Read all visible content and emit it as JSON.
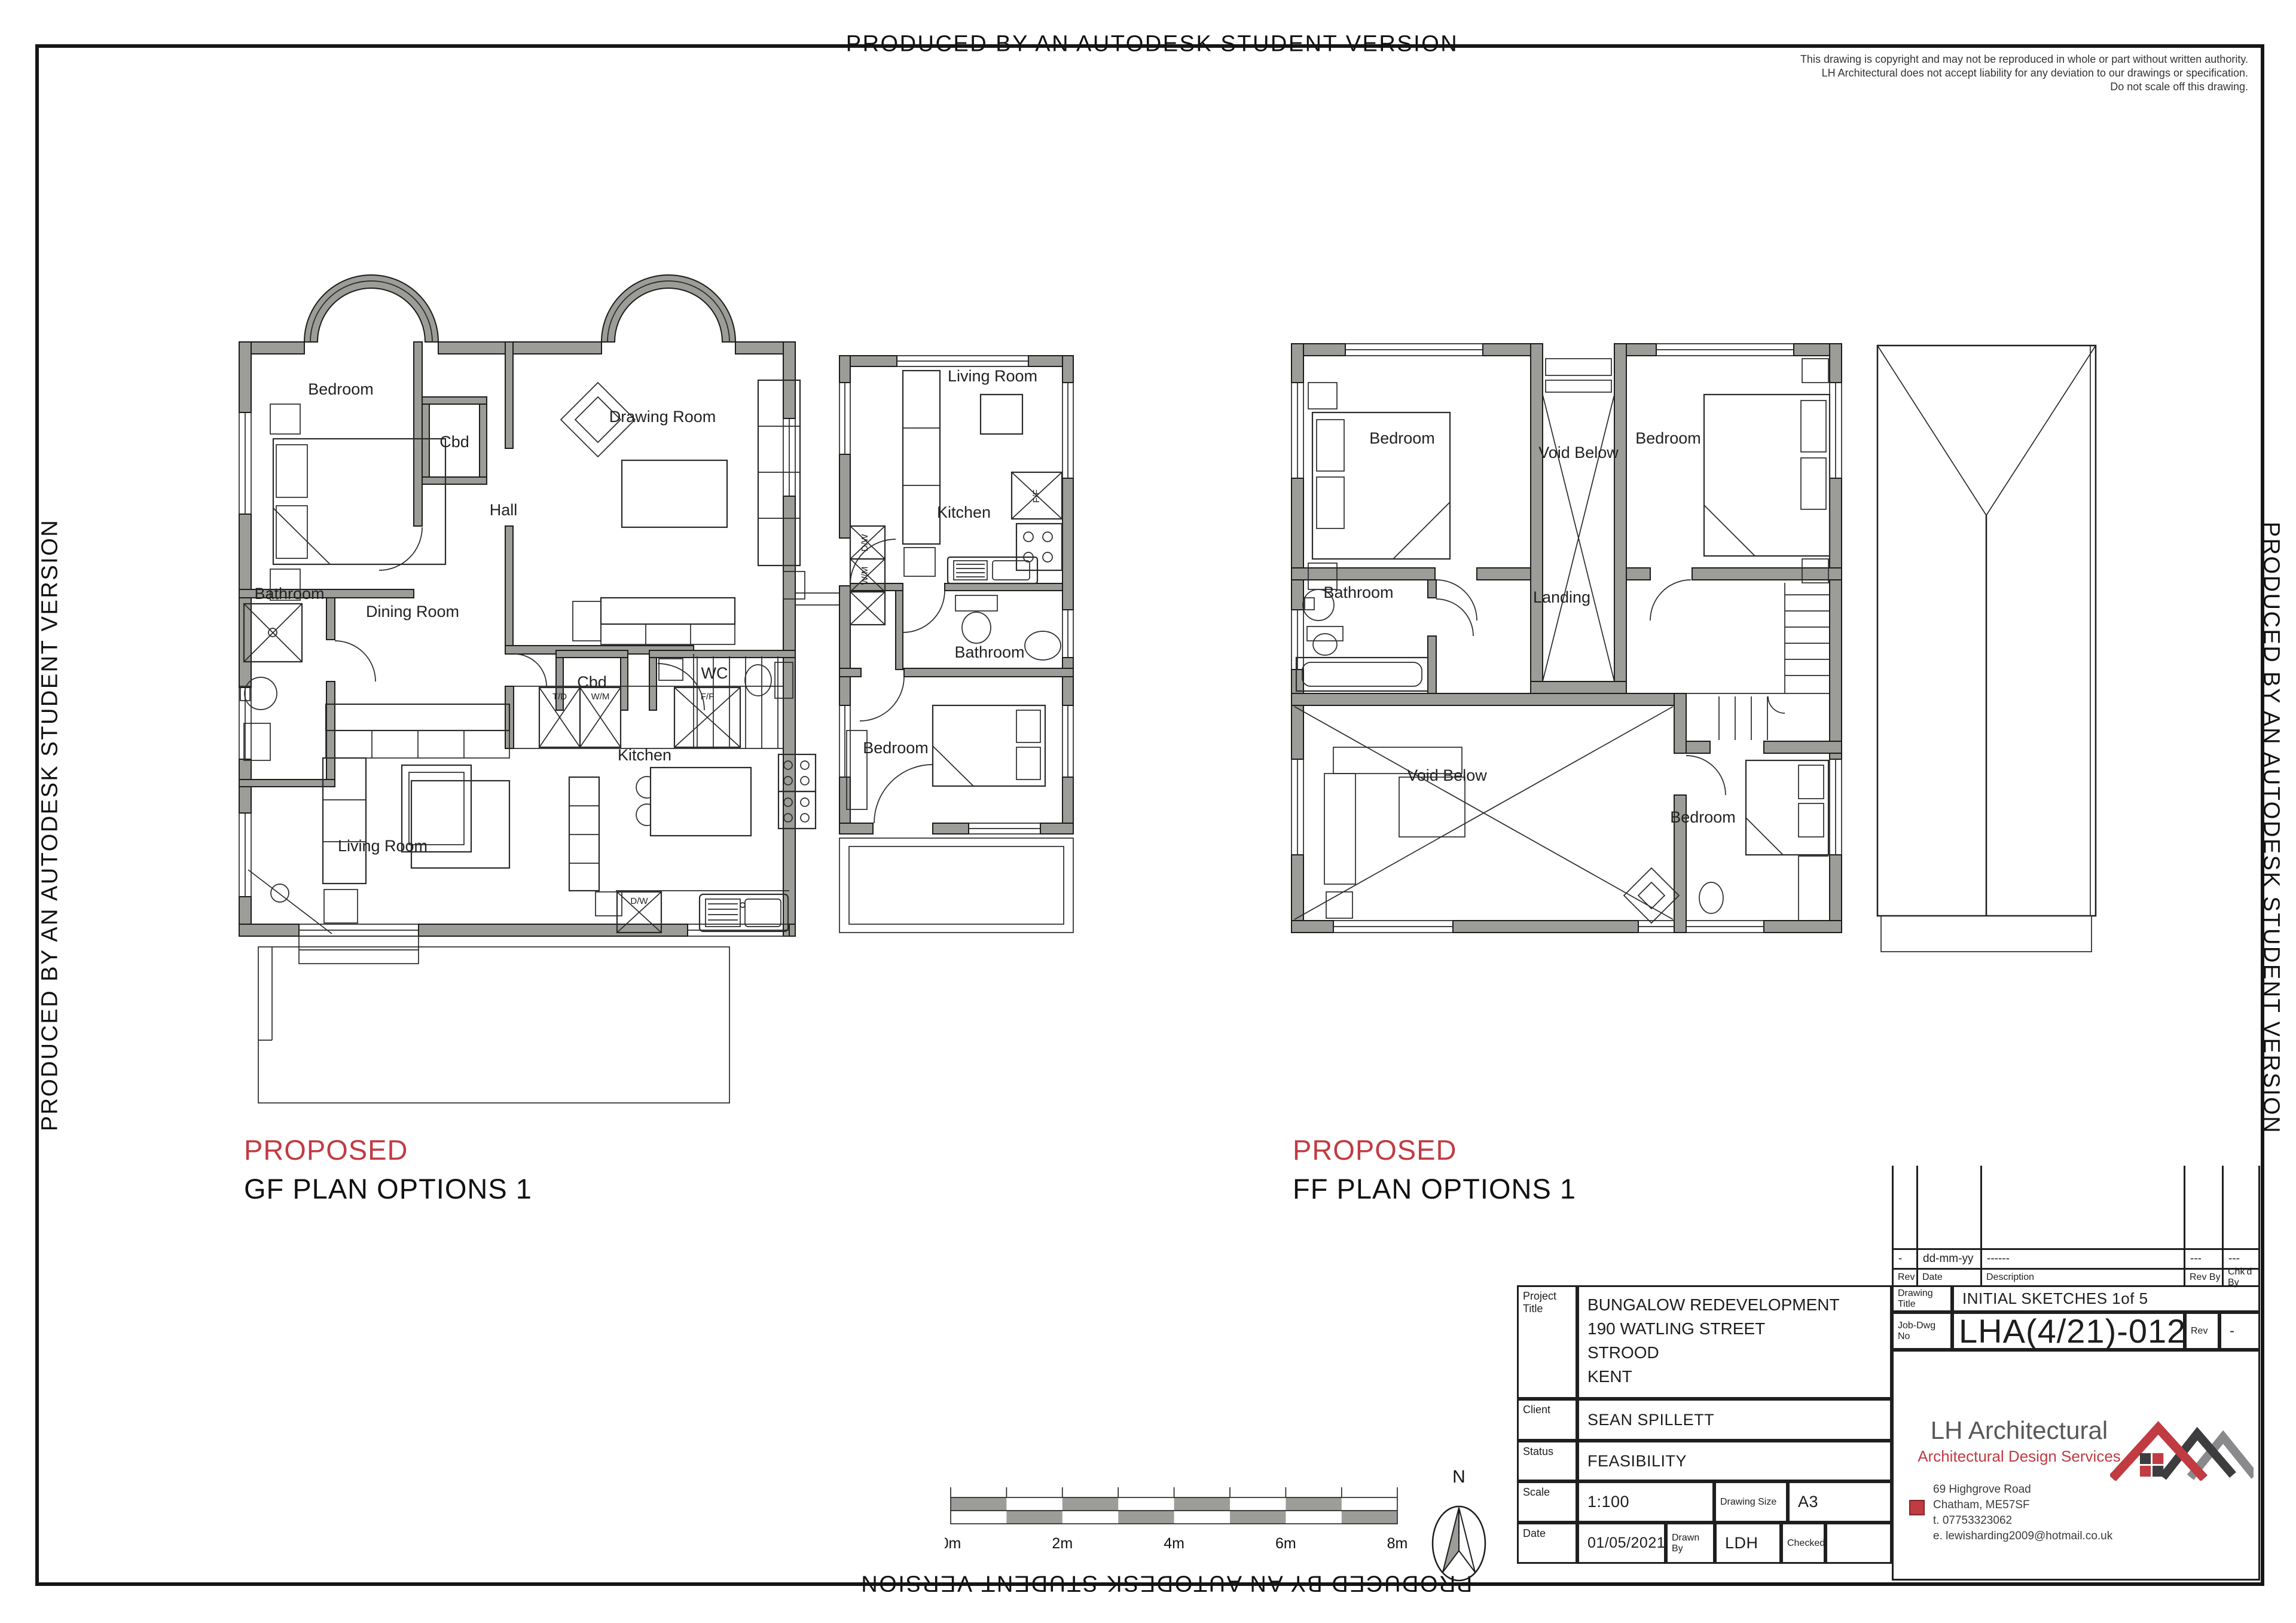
{
  "page": {
    "border_text": "PRODUCED BY AN AUTODESK STUDENT VERSION"
  },
  "copyright": {
    "line1": "This drawing is copyright and may not be reproduced in whole or part without written authority.",
    "line2": "LH Architectural does not accept liability for any deviation to our drawings or specification.",
    "line3": "Do not scale off this drawing."
  },
  "plans": {
    "gf": {
      "title_red": "PROPOSED",
      "title": "GF PLAN OPTIONS 1",
      "rooms": {
        "bedroom": "Bedroom",
        "cbd1": "Cbd",
        "drawing_room": "Drawing Room",
        "hall": "Hall",
        "bathroom": "Bathroom",
        "dining": "Dining Room",
        "cbd2": "Cbd",
        "wc": "WC",
        "kitchen": "Kitchen",
        "living": "Living Room"
      },
      "appliances": {
        "td": "T/D",
        "wm": "W/M",
        "ff": "F/F",
        "dw": "D/W"
      }
    },
    "annex": {
      "rooms": {
        "living": "Living Room",
        "kitchen": "Kitchen",
        "bathroom": "Bathroom",
        "bedroom": "Bedroom"
      }
    },
    "ff": {
      "title_red": "PROPOSED",
      "title": "FF PLAN OPTIONS 1",
      "rooms": {
        "bedroom_tl": "Bedroom",
        "bedroom_tr": "Bedroom",
        "void_top": "Void Below",
        "bathroom": "Bathroom",
        "landing": "Landing",
        "void_bottom": "Void Below",
        "bedroom_br": "Bedroom"
      }
    }
  },
  "scalebar": {
    "labels": [
      "0m",
      "2m",
      "4m",
      "6m",
      "8m"
    ]
  },
  "north": {
    "label": "N"
  },
  "revision": {
    "headers": {
      "rev": "Rev",
      "date": "Date",
      "description": "Description",
      "rev_by": "Rev By",
      "chkd_by": "Chk'd By"
    },
    "entry": {
      "rev": "-",
      "date": "dd-mm-yy",
      "description": "------",
      "rev_by": "---",
      "chkd_by": "---"
    }
  },
  "titleblock": {
    "project_title_label": "Project Title",
    "project_title": [
      "BUNGALOW REDEVELOPMENT",
      "190 WATLING STREET",
      "STROOD",
      "KENT"
    ],
    "client_label": "Client",
    "client": "SEAN SPILLETT",
    "status_label": "Status",
    "status": "FEASIBILITY",
    "scale_label": "Scale",
    "scale": "1:100",
    "size_label": "Drawing Size",
    "size": "A3",
    "date_label": "Date",
    "date": "01/05/2021",
    "drawn_label": "Drawn By",
    "drawn": "LDH",
    "checked_label": "Checked",
    "checked": "",
    "dwg_title_label": "Drawing Title",
    "dwg_title": "INITIAL SKETCHES 1of 5",
    "job_label": "Job-Dwg No",
    "job_no": "LHA(4/21)-012",
    "rev_label": "Rev",
    "rev_value": "-"
  },
  "company": {
    "name": "LH Architectural",
    "tagline": "Architectural Design Services",
    "address1": "69 Highgrove Road",
    "address2": "Chatham, ME57SF",
    "address3": "t.  07753323062",
    "address4": "e. lewisharding2009@hotmail.co.uk"
  },
  "colors": {
    "accent_red": "#c13b42",
    "wall_gray": "#9c9c98",
    "logo_dark": "#3d3d3f",
    "logo_gray": "#8a8a8c"
  }
}
